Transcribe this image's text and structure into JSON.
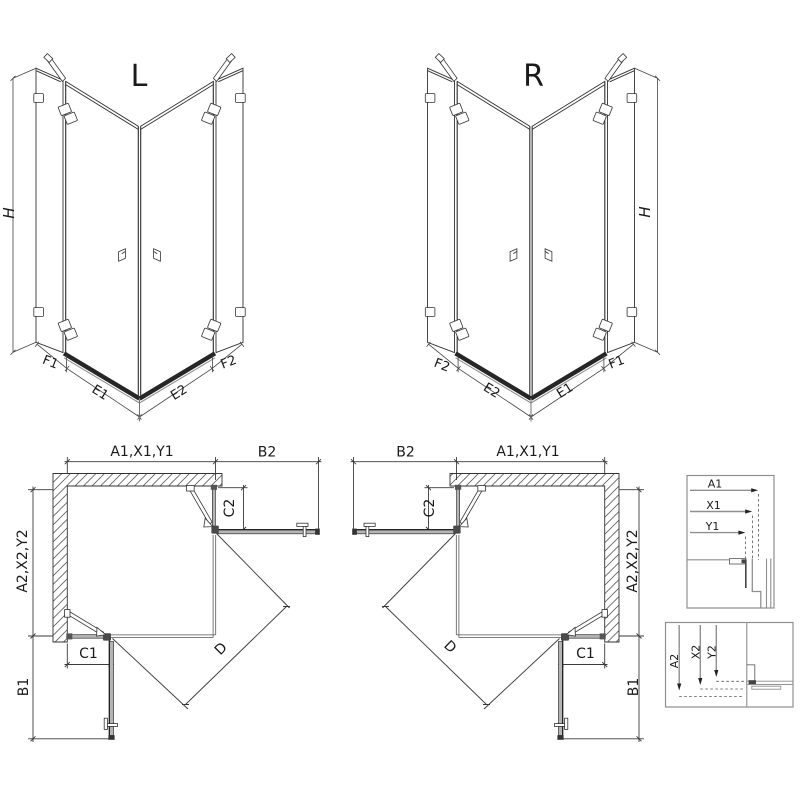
{
  "variants": {
    "left": "L",
    "right": "R"
  },
  "iso": {
    "height_label": "H",
    "segment_labels": [
      "F1",
      "E1",
      "E2",
      "F2"
    ]
  },
  "plan": {
    "width_top": "A1,X1,Y1",
    "door_projection_top": "B2",
    "depth_side": "A2,X2,Y2",
    "door_projection_side": "B1",
    "fixed_segment_top": "C2",
    "fixed_segment_side": "C1",
    "diagonal_entry": "D"
  },
  "details": {
    "width_section": [
      "A1",
      "X1",
      "Y1"
    ],
    "depth_section": [
      "A2",
      "X2",
      "Y2"
    ]
  },
  "colors": {
    "line": "#333333",
    "dimension": "#444444",
    "profile_gray": "#b4b4b4",
    "dark_profile": "#262626",
    "background": "#ffffff"
  }
}
